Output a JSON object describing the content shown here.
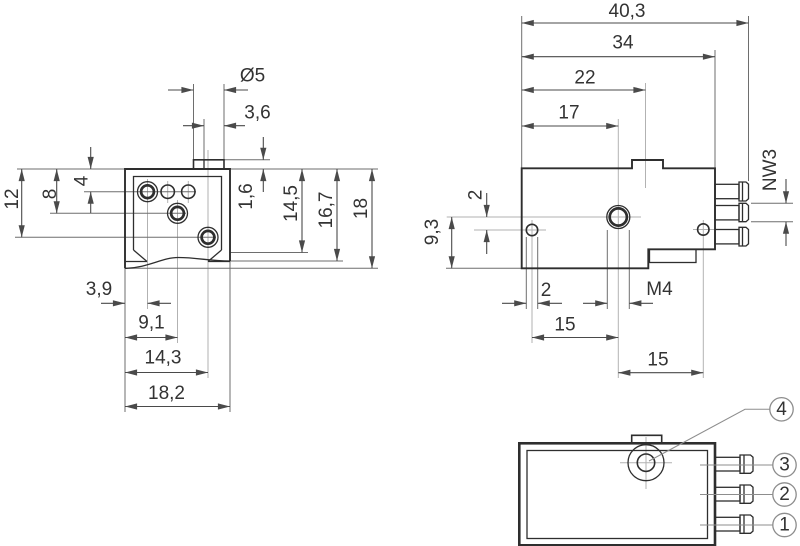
{
  "drawing_type": "technical-dimension-drawing",
  "colors": {
    "background": "#ffffff",
    "part_line": "#2e2e2e",
    "dimension_line": "#4a4a4a",
    "extension_line": "#6e6e6e",
    "center_line": "#b2b2b2",
    "text": "#333333"
  },
  "front_view": {
    "dims": {
      "stem_dia": "Ø5",
      "stem_bore": "3,6",
      "row1_y": "4",
      "row2_y": "8",
      "row3_y": "12",
      "stem_h": "1,6",
      "depth1": "14,5",
      "depth2": "16,7",
      "height": "18",
      "hole1_x": "3,9",
      "hole2_x": "9,1",
      "hole3_x": "14,3",
      "width": "18,2"
    }
  },
  "side_view": {
    "dims": {
      "total_w": "40,3",
      "body_w": "34",
      "tab_x": "22",
      "hole_x": "17",
      "nozzle": "NW3",
      "offset_y": "2",
      "hole_y": "9,3",
      "hole_dia": "2",
      "thread": "M4",
      "pitch_left": "15",
      "pitch_right": "15"
    }
  },
  "port_view": {
    "callouts": [
      {
        "label": "4"
      },
      {
        "label": "3"
      },
      {
        "label": "2"
      },
      {
        "label": "1"
      }
    ]
  }
}
